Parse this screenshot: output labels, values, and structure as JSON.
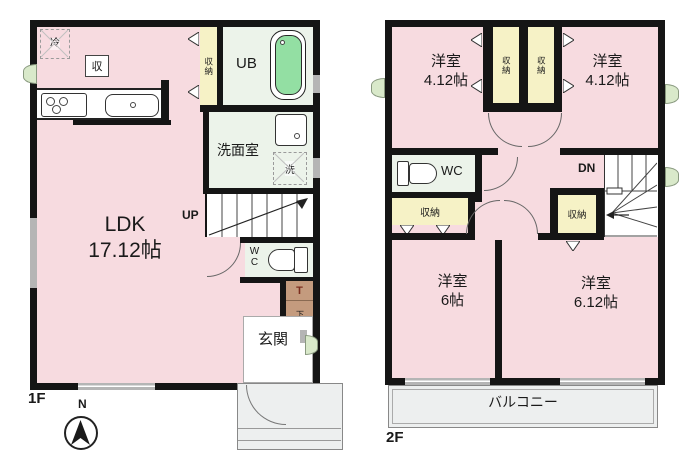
{
  "meta": {
    "floor1_label": "1F",
    "floor2_label": "2F",
    "compass_north": "N"
  },
  "f1": {
    "ldk_name": "LDK",
    "ldk_size": "17.12帖",
    "fridge": "冷",
    "storage_small": "収",
    "closet_vertical": "収納",
    "ub": "UB",
    "washroom": "洗面室",
    "washer": "洗",
    "up": "UP",
    "wc": "WC",
    "shoe_t": "T",
    "shoe_box": "下足箱",
    "entrance": "玄関"
  },
  "f2": {
    "rooms": [
      {
        "name": "洋室",
        "size": "4.12帖"
      },
      {
        "name": "洋室",
        "size": "4.12帖"
      },
      {
        "name": "洋室",
        "size": "6帖"
      },
      {
        "name": "洋室",
        "size": "6.12帖"
      }
    ],
    "closet_top_left": "収納",
    "closet_top_right": "収納",
    "closet_mid": "収納",
    "closet_stairs": "収納",
    "wc": "WC",
    "dn": "DN",
    "balcony": "バルコニー"
  },
  "colors": {
    "wall": "#151515",
    "room_pink": "#f7dbe0",
    "closet_yellow": "#f6f2c6",
    "wet_room_green": "#ecf3ea",
    "bathtub_green": "#93dfa3",
    "shoe_tan": "#c49b7e",
    "porch_gray": "#edefef",
    "window_gray": "#b5b5b5",
    "window_green": "#d9e9ca"
  }
}
